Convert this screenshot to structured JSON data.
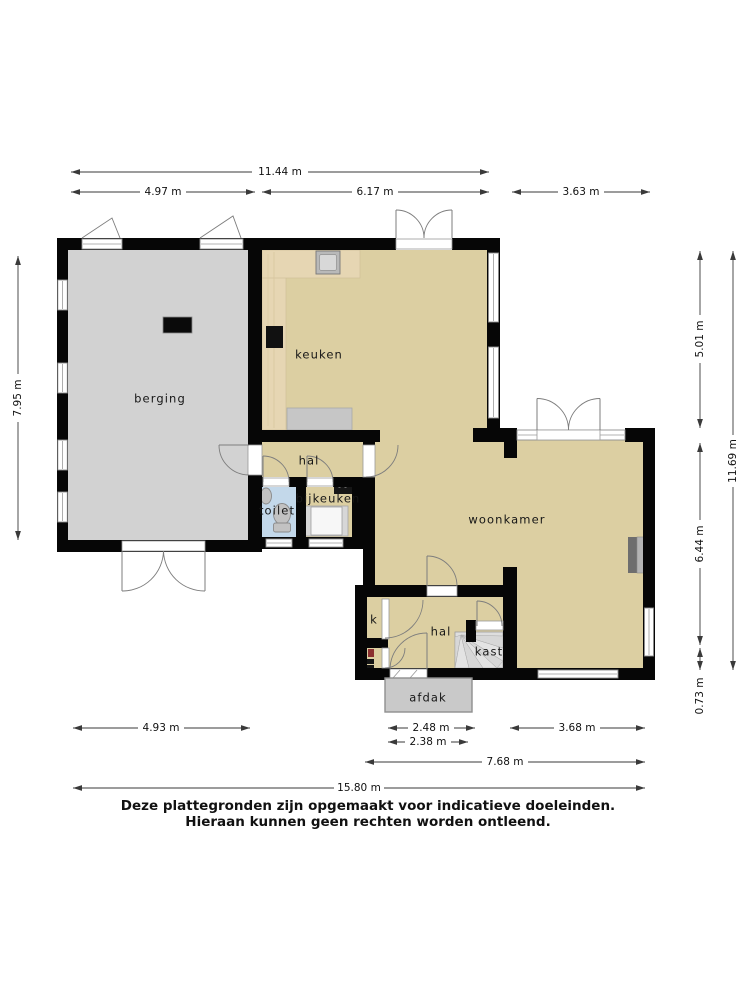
{
  "plan": {
    "rooms": {
      "berging": "berging",
      "keuken": "keuken",
      "hal_boven": "hal",
      "toilet": "toilet",
      "bijkeuken": "bijkeuken",
      "woonkamer": "woonkamer",
      "k": "k",
      "hal_beneden": "hal",
      "kast": "kast",
      "afdak": "afdak"
    }
  },
  "dimensions": {
    "top_total": "11.44 m",
    "top_left": "4.97 m",
    "top_mid": "6.17 m",
    "top_right": "3.63 m",
    "left_total": "7.95 m",
    "right_upper": "5.01 m",
    "right_mid": "6.44 m",
    "right_lower": "0.73 m",
    "right_total": "11.69 m",
    "bottom_left": "4.93 m",
    "bottom_porch": "2.48 m",
    "bottom_porch_inner": "2.38 m",
    "bottom_right": "3.68 m",
    "bottom_span": "7.68 m",
    "bottom_total": "15.80 m"
  },
  "disclaimer": {
    "line1": "Deze plattegronden zijn opgemaakt voor indicatieve doeleinden.",
    "line2": "Hieraan kunnen geen rechten worden ontleend."
  },
  "colors": {
    "wall": "#060606",
    "floor_main": "#DCCFA2",
    "floor_storage": "#D2D2D2",
    "floor_toilet": "#C3D8EA",
    "counter_wood": "#E6D6B3",
    "dimension_line": "#3a3a3a"
  }
}
